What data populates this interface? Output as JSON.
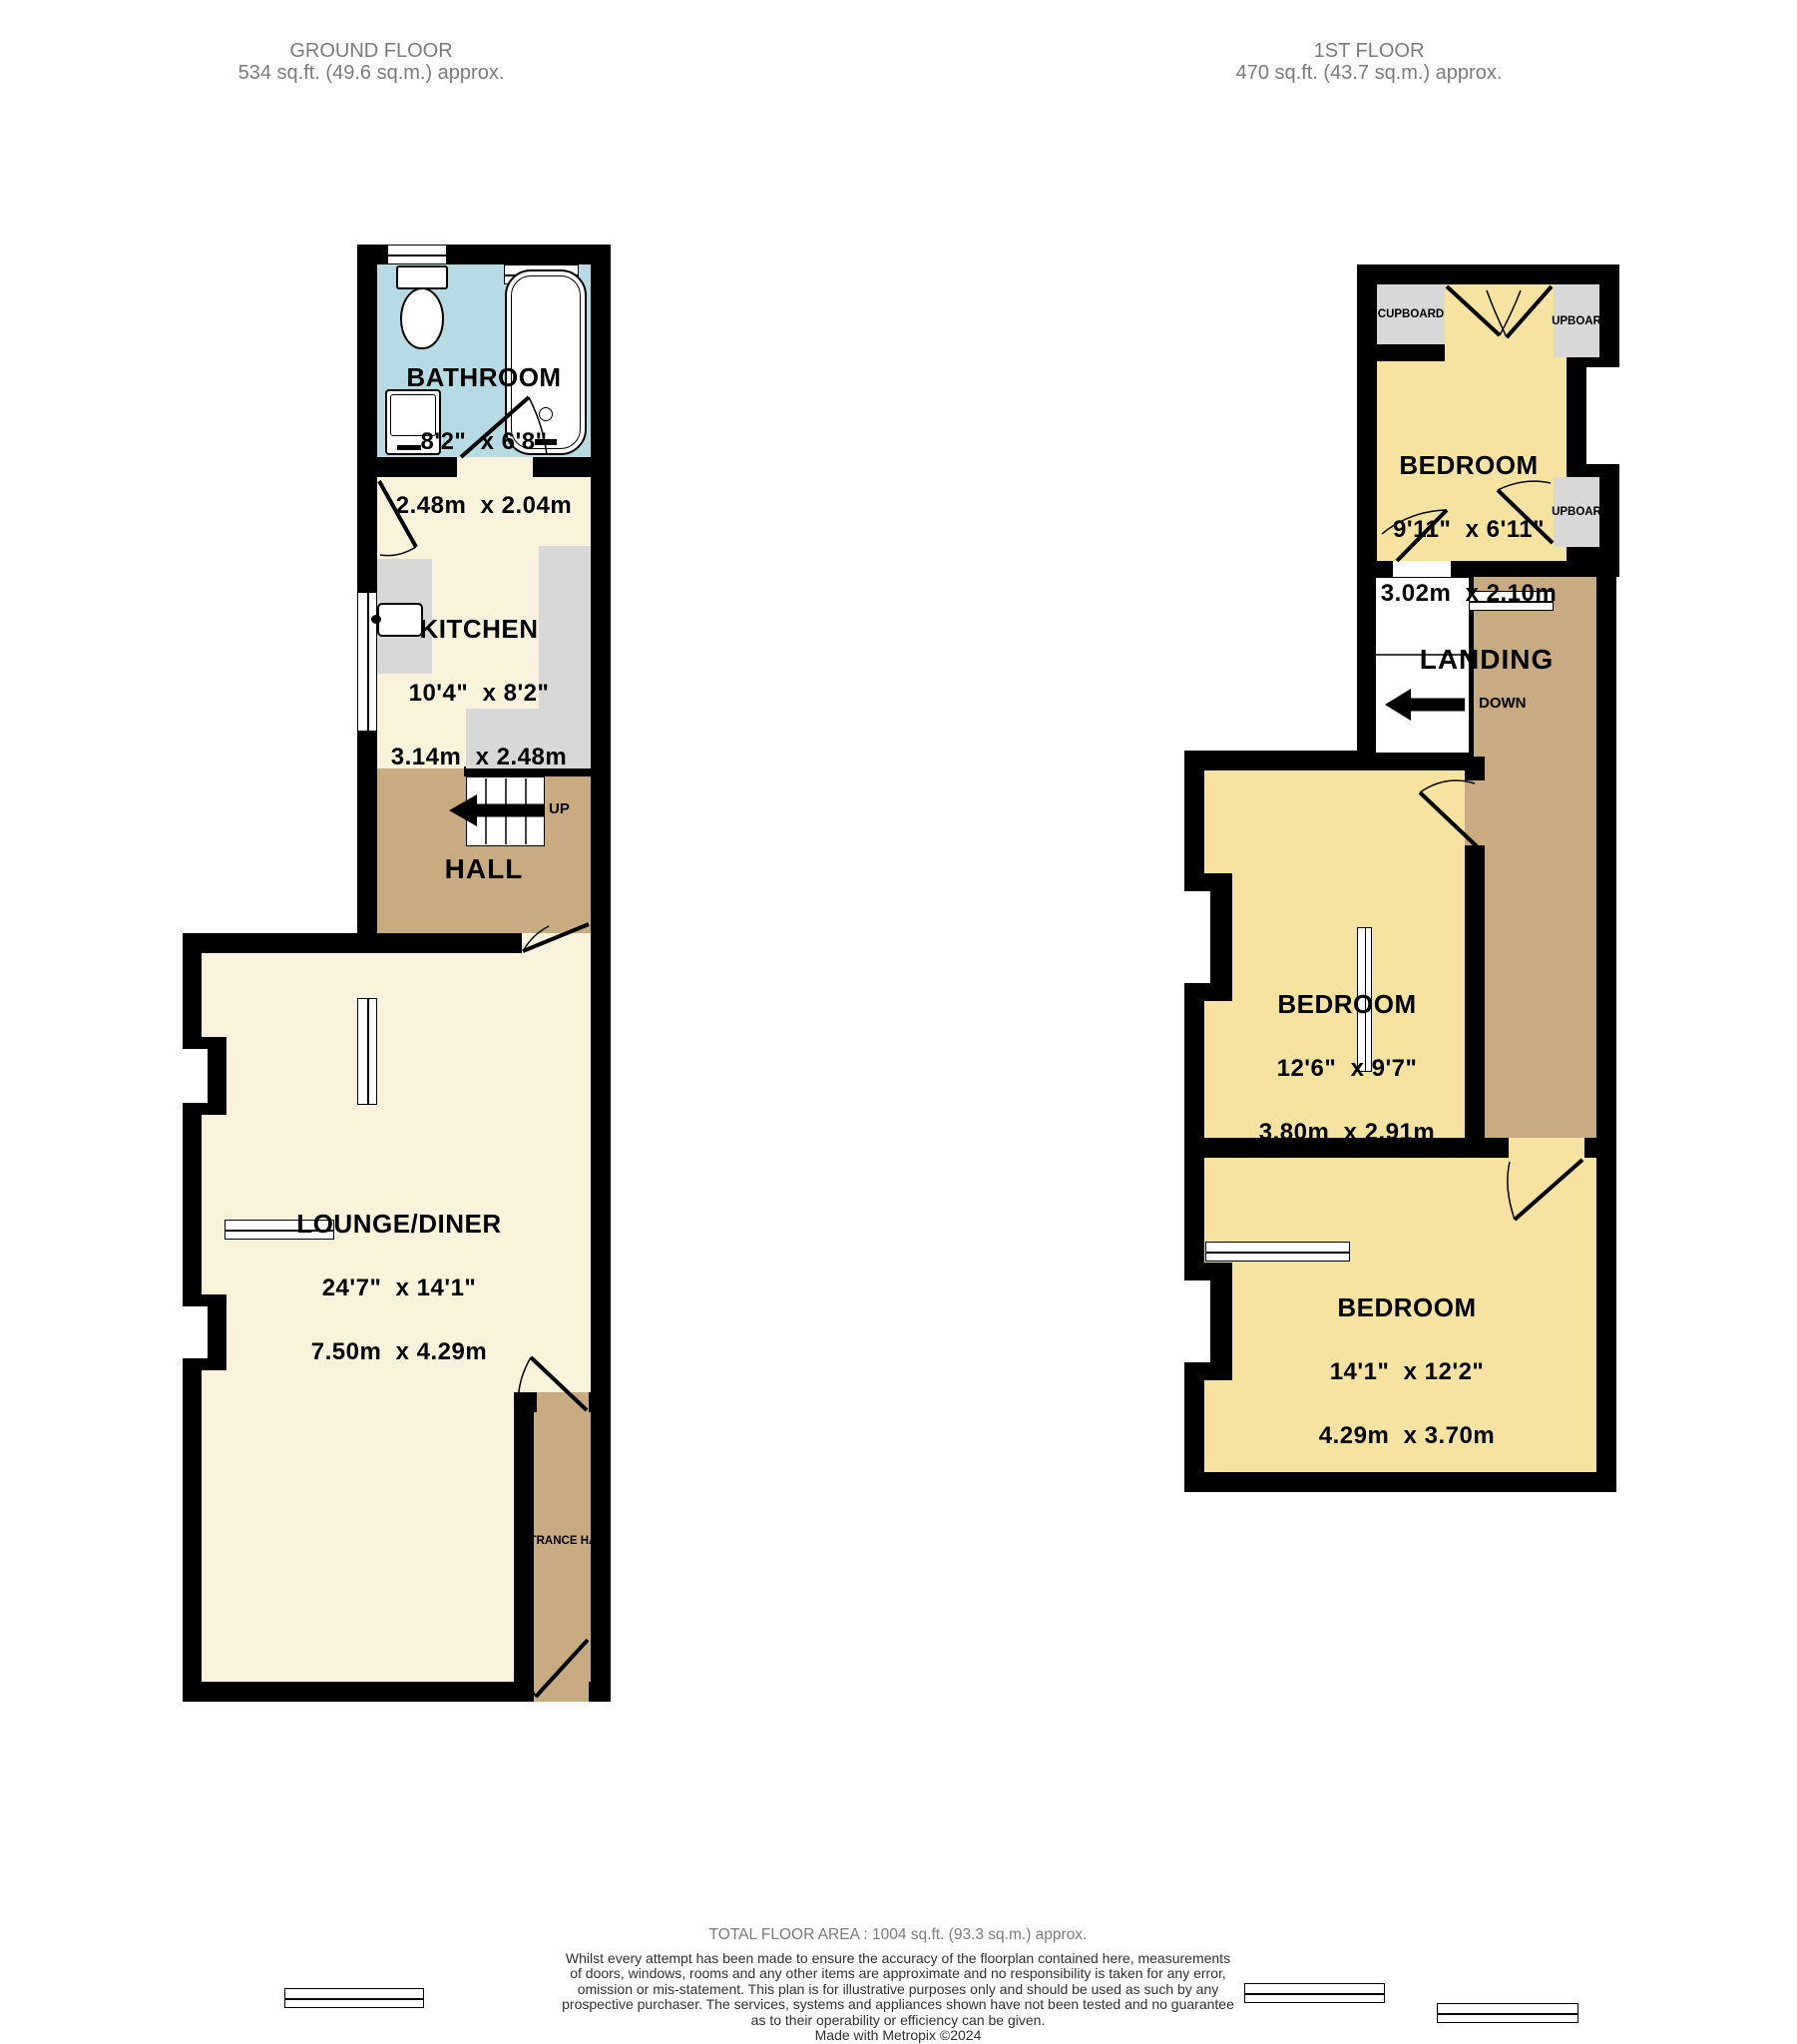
{
  "titles": {
    "ground": {
      "name": "GROUND FLOOR",
      "area": "534 sq.ft. (49.6 sq.m.) approx."
    },
    "first": {
      "name": "1ST FLOOR",
      "area": "470 sq.ft. (43.7 sq.m.) approx."
    }
  },
  "ground_floor": {
    "bathroom": {
      "name": "BATHROOM",
      "imperial": "8'2\"  x 6'8\"",
      "metric": "2.48m  x 2.04m"
    },
    "kitchen": {
      "name": "KITCHEN",
      "imperial": "10'4\"  x 8'2\"",
      "metric": "3.14m  x 2.48m"
    },
    "hall": {
      "name": "HALL"
    },
    "stairs": {
      "label": "UP"
    },
    "lounge": {
      "name": "LOUNGE/DINER",
      "imperial": "24'7\"  x 14'1\"",
      "metric": "7.50m  x 4.29m"
    },
    "entrance_hall": {
      "name": "ENTRANCE HALL"
    }
  },
  "first_floor": {
    "bedroom_small": {
      "name": "BEDROOM",
      "imperial": "9'11\"  x 6'11\"",
      "metric": "3.02m  x 2.10m"
    },
    "bedroom_middle": {
      "name": "BEDROOM",
      "imperial": "12'6\"  x 9'7\"",
      "metric": "3.80m  x 2.91m"
    },
    "bedroom_large": {
      "name": "BEDROOM",
      "imperial": "14'1\"  x 12'2\"",
      "metric": "4.29m  x 3.70m"
    },
    "landing": {
      "name": "LANDING"
    },
    "stairs": {
      "label": "DOWN"
    },
    "cupboard_top_left": {
      "name": "CUPBOARD"
    },
    "cupboard_top_right": {
      "name": "CUPBOARD"
    },
    "cupboard_mid_right": {
      "name": "CUPBOARD"
    }
  },
  "footer": {
    "total_area": "TOTAL FLOOR AREA : 1004 sq.ft. (93.3 sq.m.) approx.",
    "disclaimer_lines": [
      "Whilst every attempt has been made to ensure the accuracy of the floorplan contained here, measurements",
      "of doors, windows, rooms and any other items are approximate and no responsibility is taken for any error,",
      "omission or mis-statement. This plan is for illustrative purposes only and should be used as such by any",
      "prospective purchaser. The services, systems and appliances shown have not been tested and no guarantee",
      "as to their operability or efficiency can be given."
    ],
    "credit": "Made with Metropix ©2024"
  },
  "colors": {
    "room_cream": "#f8f3da",
    "room_yellow": "#f6e3a1",
    "hall_tan": "#c8ab81",
    "bathroom_blue": "#b7dbe4",
    "cupboard_gray": "#d8d8d8",
    "wall_black": "#000000"
  }
}
